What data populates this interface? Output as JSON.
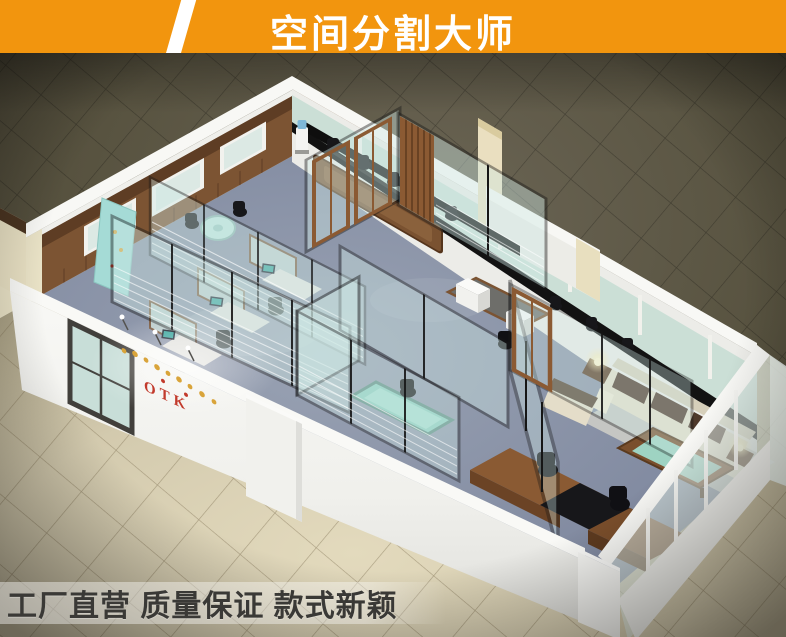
{
  "banner": {
    "title": "空间分割大师",
    "bg_color": "#F2950E",
    "slash_color": "#FFFFFF",
    "text_color": "#FFFFFF"
  },
  "scene": {
    "logo_text": "OTK",
    "colors": {
      "floor_dark_olive": "#55503F",
      "floor_light_beige": "#D9D0B3",
      "wall_white": "#F3F3EF",
      "carpet_blue_gray": "#8A93A5",
      "partition_glass": "#CFE9E5",
      "partition_frame": "#161616",
      "wood_brown": "#7B5433",
      "sofa_cream": "#E2DBC7",
      "cushion_dark_brown": "#4E392C",
      "glass_table_green": "#8FD0C0",
      "poster_teal": "#A8DED9",
      "logo_red": "#C23A2C",
      "logo_gold": "#D9A43A"
    }
  },
  "footer": {
    "slogan": "工厂直营  质量保证  款式新颖",
    "text_color": "#3A3936",
    "band_color": "rgba(255,255,255,0.40)"
  }
}
